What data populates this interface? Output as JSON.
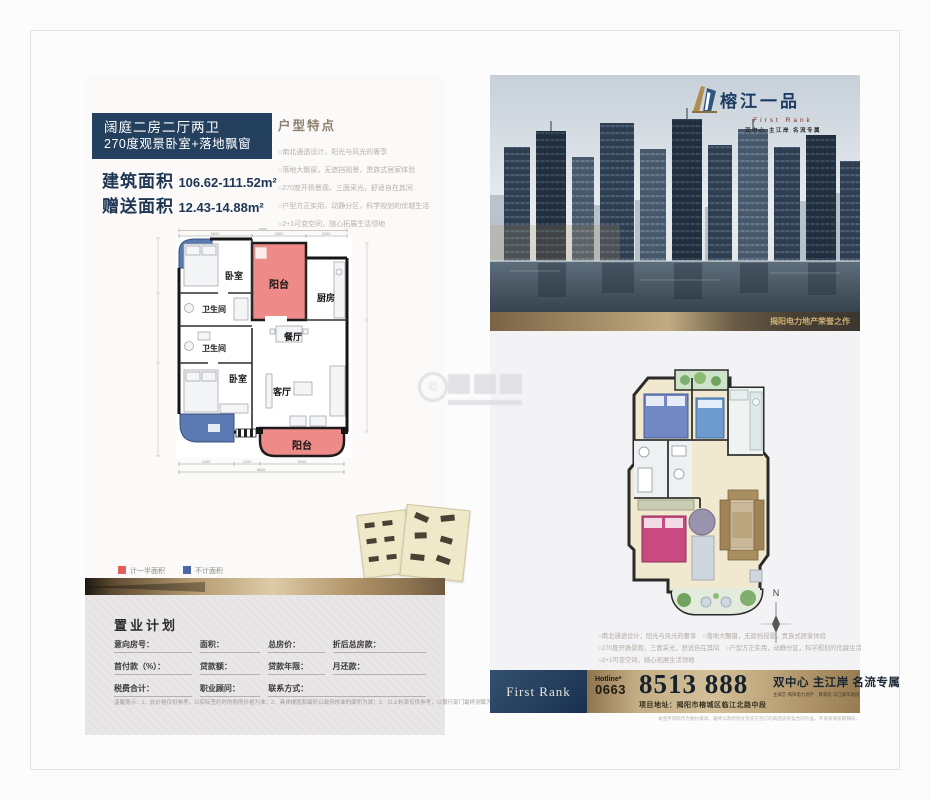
{
  "colors": {
    "navy": "#24405f",
    "gold": "#b49a70",
    "balcony_half_area": "#ee8a87",
    "no_count_area": "#5c7ab2",
    "legend_half": "#e05f5f",
    "legend_none": "#4a69a8"
  },
  "watermark": {
    "symbol": "©"
  },
  "left": {
    "headline1": "阔庭二房二厅两卫",
    "headline2": "270度观景卧室+落地飘窗",
    "area_build_label": "建筑面积",
    "area_build_value": "106.62-111.52m²",
    "area_gift_label": "赠送面积",
    "area_gift_value": "12.43-14.88m²",
    "features_title": "户型特点",
    "features": [
      "○南北通透设计，阳光与风光的奢享",
      "○落地大飘窗，无遮挡视景，贵族式居家体验",
      "○270度开扬景观，三面采光，舒适自在其间",
      "○户型方正实用，动静分区，科学规划的优越生活",
      "○2+1可变空间，随心拓展生活领地"
    ],
    "plan": {
      "rooms": {
        "bed1": "卧室",
        "balc1": "阳台",
        "kitchen": "厨房",
        "bath1": "卫生间",
        "bath2": "卫生间",
        "dining": "餐厅",
        "bed2": "卧室",
        "living": "客厅",
        "balc2": "阳台"
      },
      "dims": {
        "top_total": "9600",
        "top": [
          "5600",
          "2800",
          "2200"
        ],
        "bottom": [
          "2400",
          "1200",
          "5000"
        ],
        "bottom_total": "8600"
      }
    },
    "legend": {
      "half": "计一半面积",
      "none": "不计面积"
    },
    "form": {
      "title": "置业计划",
      "row1": [
        "意向房号：",
        "面积：",
        "总房价：",
        "折后总房款："
      ],
      "row2": [
        "首付款（%）：",
        "贷款额：",
        "贷款年限：",
        "月还款："
      ],
      "row3": [
        "税费合计：",
        "职业顾问：",
        "联系方式："
      ],
      "note": "温馨提示：1、此价格仅供参考，以实际签约时的购房价格为准；2、具体楼层和面积以政府核准的面积为准；3、以上利率仅供参考，以银行部门最终测算为准。"
    }
  },
  "right": {
    "logo": {
      "title": "榕江一品",
      "sub": "First Rank",
      "tagline": "双中心 主江岸 名流专属"
    },
    "photo_caption": "揭阳电力地产荣誉之作",
    "compass_n": "N",
    "feature_lines": [
      "○南北通透设计，阳光与风光的奢享　○落地大飘窗，无遮挡视景，贵族式居家体验",
      "○270度开扬景观，三面采光，舒适自在其间　○户型方正实用，动静分区，科学规划的优越生活",
      "○2+1可变空间，随心拓展生活领地"
    ],
    "bar": {
      "brand": "First Rank",
      "hotline_label": "Hotline*",
      "area_code": "0663",
      "number": "8513 888",
      "slogan": "双中心 主江岸 名流专属",
      "slogan_sub": "主城芯·揭阳电力地产　尊荣居·滨江豪华地段",
      "address": "项目地址：揭阳市榕城区临江北路中段"
    },
    "disclaimer": "本宣传资料仅为要约邀请，最终以政府批文及双方签订的商品房买卖合同为准，开发商保留解释权。"
  }
}
